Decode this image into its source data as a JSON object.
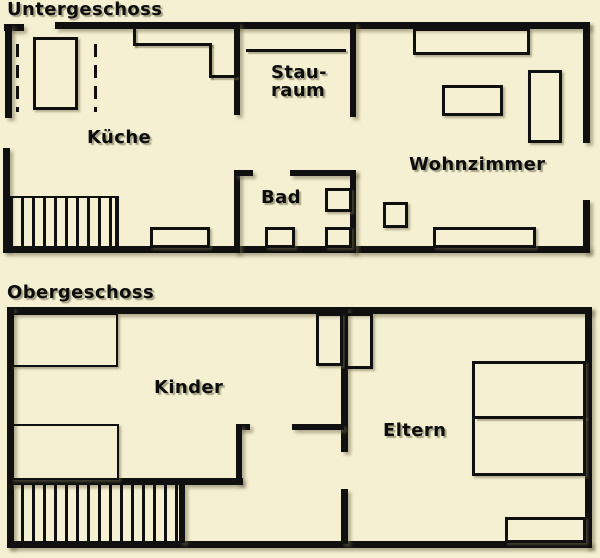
{
  "colors": {
    "background": "#f5f0d2",
    "wall": "#101010",
    "text": "#0d0d0d",
    "shadow": "rgba(115,108,78,0.5)"
  },
  "floors": [
    {
      "name": "untergeschoss",
      "title": "Untergeschoss",
      "title_pos": {
        "x": 7,
        "y": 1
      },
      "labels": [
        {
          "name": "room-label-kueche",
          "text": "Küche",
          "x": 87,
          "y": 129
        },
        {
          "name": "room-label-stauraum",
          "text": "Stau-\nraum",
          "x": 271,
          "y": 64
        },
        {
          "name": "room-label-wohnzimmer",
          "text": "Wohnzimmer",
          "x": 409,
          "y": 156
        },
        {
          "name": "room-label-bad",
          "text": "Bad",
          "x": 261,
          "y": 189
        }
      ],
      "walls": [
        {
          "name": "outer-top-wall",
          "x": 55,
          "y": 22,
          "w": 535,
          "h": 7
        },
        {
          "name": "entry-stub-wall",
          "x": 4,
          "y": 24,
          "w": 20,
          "h": 7
        },
        {
          "name": "left-wall-upper",
          "x": 5,
          "y": 24,
          "w": 7,
          "h": 94
        },
        {
          "name": "left-wall-lower",
          "x": 3,
          "y": 148,
          "w": 7,
          "h": 103
        },
        {
          "name": "outer-bottom-wall",
          "x": 3,
          "y": 246,
          "w": 587,
          "h": 7
        },
        {
          "name": "right-wall-upper",
          "x": 583,
          "y": 22,
          "w": 7,
          "h": 121
        },
        {
          "name": "right-wall-lower",
          "x": 583,
          "y": 200,
          "w": 7,
          "h": 53
        },
        {
          "name": "kueche-stauraum-wall",
          "x": 234,
          "y": 22,
          "w": 6,
          "h": 93
        },
        {
          "name": "stauraum-wohnzimmer-wall",
          "x": 350,
          "y": 22,
          "w": 6,
          "h": 95
        },
        {
          "name": "bad-left-wall",
          "x": 234,
          "y": 170,
          "w": 6,
          "h": 83
        },
        {
          "name": "bad-door-stub",
          "x": 234,
          "y": 170,
          "w": 19,
          "h": 6
        },
        {
          "name": "bad-top-wall",
          "x": 290,
          "y": 170,
          "w": 66,
          "h": 6
        },
        {
          "name": "bad-right-wall",
          "x": 350,
          "y": 170,
          "w": 6,
          "h": 83
        }
      ],
      "lines": [
        {
          "name": "kitchen-counter-line-1",
          "x": 133,
          "y": 28,
          "w": 3,
          "h": 18
        },
        {
          "name": "kitchen-counter-line-2",
          "x": 133,
          "y": 43,
          "w": 79,
          "h": 3
        },
        {
          "name": "kitchen-counter-line-3",
          "x": 209,
          "y": 43,
          "w": 3,
          "h": 35
        },
        {
          "name": "kitchen-counter-line-4",
          "x": 209,
          "y": 75,
          "w": 28,
          "h": 3
        },
        {
          "name": "stauraum-shelf-line",
          "x": 246,
          "y": 49,
          "w": 100,
          "h": 3
        }
      ],
      "dashes": [
        {
          "name": "kitchen-dashed-line-left",
          "x": 16,
          "y": 44,
          "w": 3,
          "h": 68
        },
        {
          "name": "kitchen-dashed-line-right",
          "x": 94,
          "y": 44,
          "w": 3,
          "h": 68
        }
      ],
      "boxes": [
        {
          "name": "kitchen-appliance",
          "x": 33,
          "y": 37,
          "w": 45,
          "h": 73
        },
        {
          "name": "kitchen-unit",
          "x": 150,
          "y": 227,
          "w": 60,
          "h": 21
        },
        {
          "name": "sideboard",
          "x": 413,
          "y": 28,
          "w": 117,
          "h": 27
        },
        {
          "name": "coffee-table",
          "x": 442,
          "y": 85,
          "w": 61,
          "h": 31
        },
        {
          "name": "cabinet",
          "x": 528,
          "y": 70,
          "w": 34,
          "h": 73
        },
        {
          "name": "side-table",
          "x": 383,
          "y": 202,
          "w": 25,
          "h": 26
        },
        {
          "name": "sofa",
          "x": 433,
          "y": 227,
          "w": 103,
          "h": 21
        },
        {
          "name": "bad-toilet",
          "x": 265,
          "y": 227,
          "w": 30,
          "h": 21
        },
        {
          "name": "bad-fixture-upper",
          "x": 325,
          "y": 188,
          "w": 27,
          "h": 24
        },
        {
          "name": "bad-fixture-lower",
          "x": 325,
          "y": 227,
          "w": 27,
          "h": 21
        }
      ],
      "stairs": [
        {
          "name": "stairs-lower-floor",
          "x": 8,
          "y": 196,
          "w": 111,
          "h": 50,
          "top": true,
          "right": true
        }
      ]
    },
    {
      "name": "obergeschoss",
      "title": "Obergeschoss",
      "title_pos": {
        "x": 7,
        "y": 284
      },
      "labels": [
        {
          "name": "room-label-kinder",
          "text": "Kinder",
          "x": 154,
          "y": 379
        },
        {
          "name": "room-label-eltern",
          "text": "Eltern",
          "x": 383,
          "y": 422
        }
      ],
      "walls": [
        {
          "name": "outer-top-wall",
          "x": 7,
          "y": 307,
          "w": 585,
          "h": 7
        },
        {
          "name": "left-wall",
          "x": 7,
          "y": 307,
          "w": 7,
          "h": 241
        },
        {
          "name": "outer-bottom-wall",
          "x": 7,
          "y": 541,
          "w": 585,
          "h": 7
        },
        {
          "name": "right-wall",
          "x": 585,
          "y": 307,
          "w": 7,
          "h": 241
        },
        {
          "name": "kinder-eltern-wall-upper",
          "x": 341,
          "y": 307,
          "w": 7,
          "h": 145
        },
        {
          "name": "kinder-eltern-wall-lower",
          "x": 341,
          "y": 489,
          "w": 7,
          "h": 55
        },
        {
          "name": "eltern-door-wall",
          "x": 292,
          "y": 424,
          "w": 52,
          "h": 6
        },
        {
          "name": "stair-stub-top",
          "x": 236,
          "y": 424,
          "w": 14,
          "h": 6
        },
        {
          "name": "stair-stub-wall",
          "x": 236,
          "y": 424,
          "w": 6,
          "h": 60
        },
        {
          "name": "kinder-bottom-wall",
          "x": 7,
          "y": 478,
          "w": 236,
          "h": 7
        },
        {
          "name": "stairs-side-wall",
          "x": 179,
          "y": 485,
          "w": 6,
          "h": 58
        }
      ],
      "lines": [
        {
          "name": "bed-divider-line",
          "x": 475,
          "y": 416,
          "w": 111,
          "h": 3
        }
      ],
      "boxes": [
        {
          "name": "kinder-wardrobe-top",
          "x": 11,
          "y": 313,
          "w": 107,
          "h": 54,
          "bw": 2
        },
        {
          "name": "kinder-wardrobe-bottom",
          "x": 11,
          "y": 424,
          "w": 108,
          "h": 56,
          "bw": 2
        },
        {
          "name": "kinder-closet",
          "x": 316,
          "y": 313,
          "w": 27,
          "h": 53
        },
        {
          "name": "eltern-closet",
          "x": 345,
          "y": 313,
          "w": 28,
          "h": 56
        },
        {
          "name": "eltern-bed",
          "x": 472,
          "y": 361,
          "w": 114,
          "h": 115
        },
        {
          "name": "eltern-dresser",
          "x": 505,
          "y": 517,
          "w": 81,
          "h": 26
        }
      ],
      "stairs": [
        {
          "name": "stairs-upper-floor",
          "x": 8,
          "y": 485,
          "w": 171,
          "h": 56
        }
      ]
    }
  ]
}
